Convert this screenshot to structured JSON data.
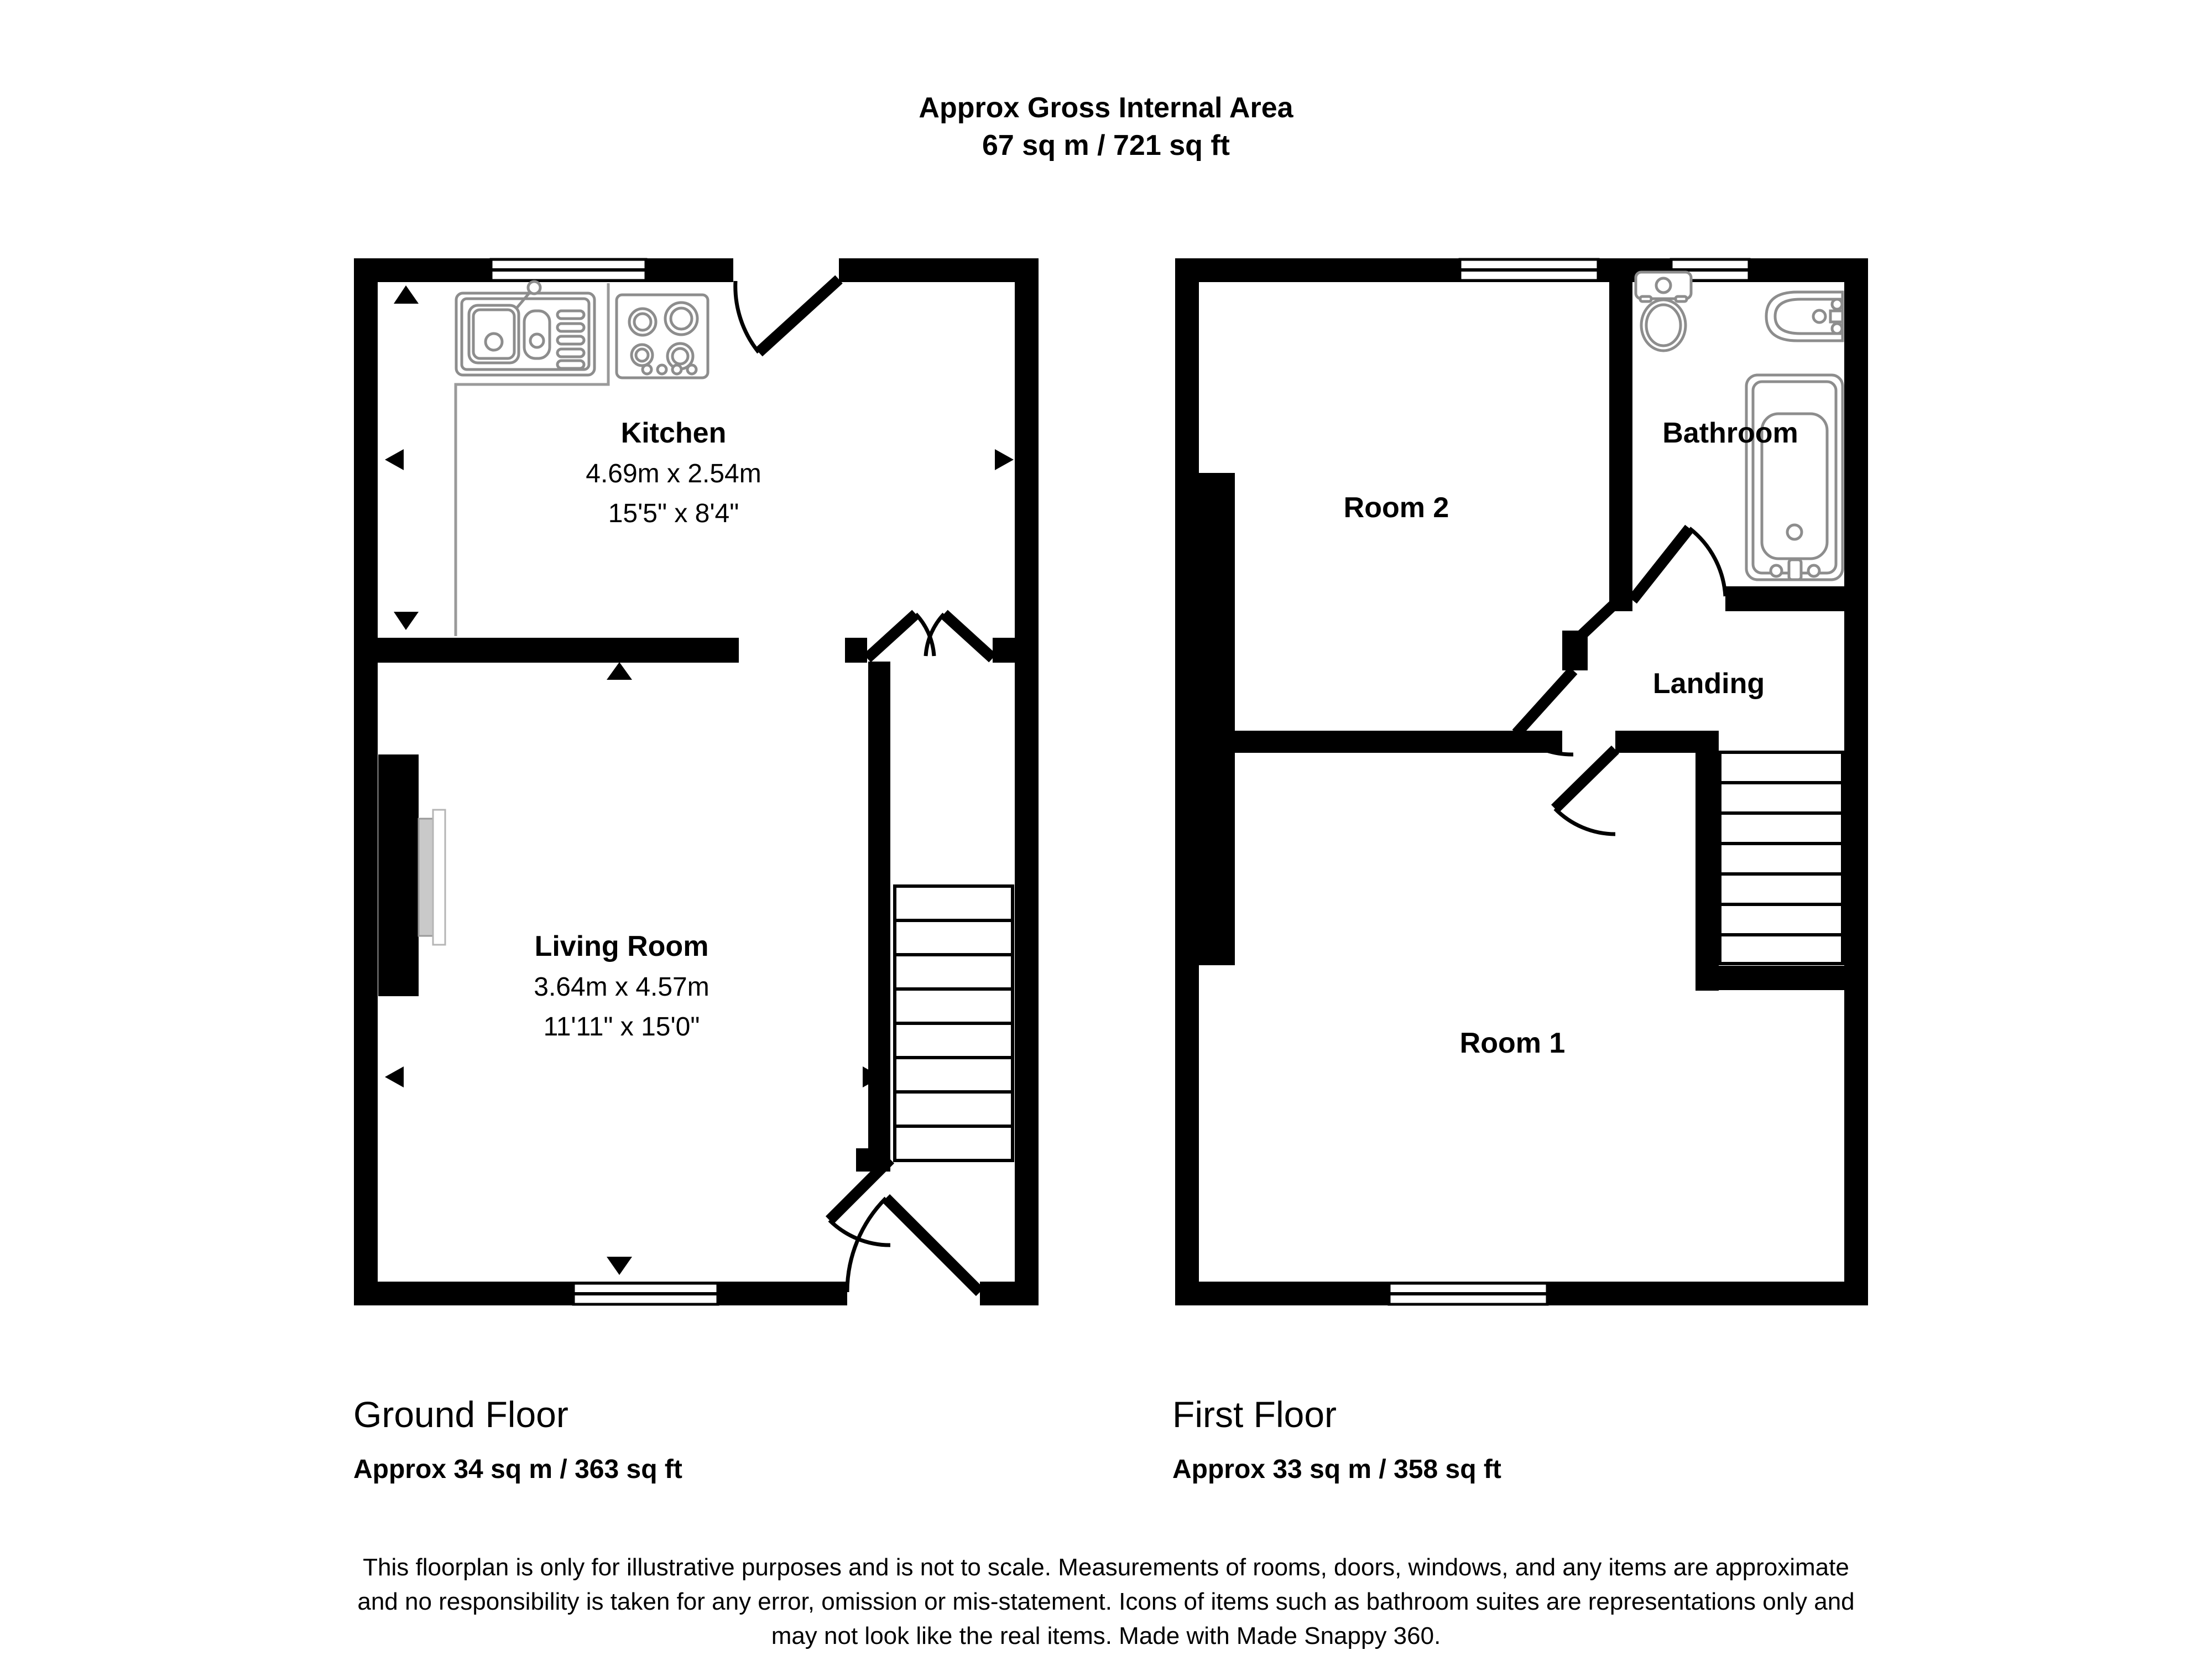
{
  "title": {
    "line1": "Approx Gross Internal Area",
    "line2": "67 sq m / 721 sq ft"
  },
  "ground_floor": {
    "name": "Ground Floor",
    "area_label": "Approx 34 sq m / 363 sq ft",
    "kitchen": {
      "name": "Kitchen",
      "dim_metric": "4.69m x 2.54m",
      "dim_imperial": "15'5\" x 8'4\""
    },
    "living_room": {
      "name": "Living Room",
      "dim_metric": "3.64m x 4.57m",
      "dim_imperial": "11'11\" x 15'0\""
    }
  },
  "first_floor": {
    "name": "First Floor",
    "area_label": "Approx 33 sq m / 358 sq ft",
    "room2": {
      "name": "Room 2"
    },
    "bathroom": {
      "name": "Bathroom"
    },
    "landing": {
      "name": "Landing"
    },
    "room1": {
      "name": "Room 1"
    }
  },
  "disclaimer": {
    "line1": "This floorplan is only for illustrative purposes and is not to scale. Measurements of rooms, doors, windows, and any items are approximate",
    "line2": "and no responsibility is taken for any error, omission or mis-statement. Icons of items such as bathroom suites are representations only and",
    "line3": "may not look like the real items. Made with Made Snappy 360."
  },
  "icons": {
    "sink": "sink-icon",
    "hob": "hob-icon",
    "toilet": "toilet-icon",
    "basin": "basin-icon",
    "bathtub": "bathtub-icon"
  },
  "colors": {
    "wall": "#000000",
    "fixture_outline": "#8d8d8d",
    "counter_line": "#9a9a9a",
    "fireplace_fill": "#c9c9c9",
    "background": "#ffffff"
  }
}
